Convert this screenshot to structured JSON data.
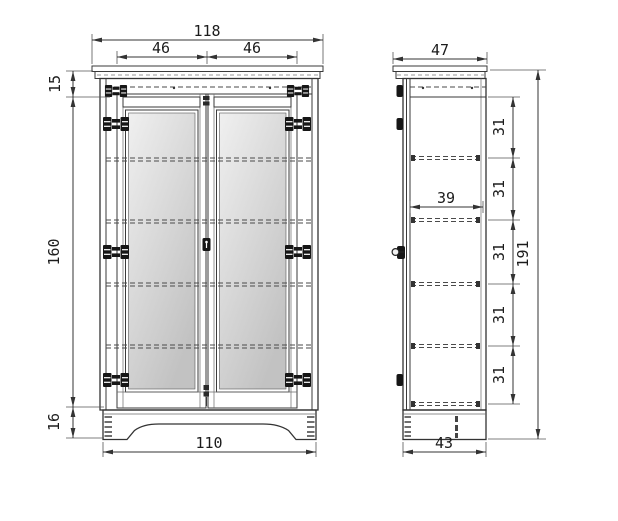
{
  "front_view": {
    "dims": {
      "overall_width": "118",
      "left_door_width": "46",
      "right_door_width": "46",
      "cornice_height": "15",
      "carcass_height": "160",
      "plinth_height": "16",
      "plinth_width": "110"
    }
  },
  "side_view": {
    "dims": {
      "top_depth": "47",
      "interior_depth": "39",
      "shelf_gaps": [
        "31",
        "31",
        "31",
        "31",
        "31"
      ],
      "overall_height": "191",
      "base_depth": "43"
    }
  },
  "colors": {
    "line": "#3a3a3a",
    "dimension_line": "#333333",
    "body_fill": "#d7d7d7",
    "door_fill": "#d4d4d4",
    "panel_light": "#f0f0f0",
    "panel_dark": "#c2c2c2",
    "plinth_fill": "#cdcdcd",
    "hardware": "#161616",
    "background": "#ffffff"
  }
}
